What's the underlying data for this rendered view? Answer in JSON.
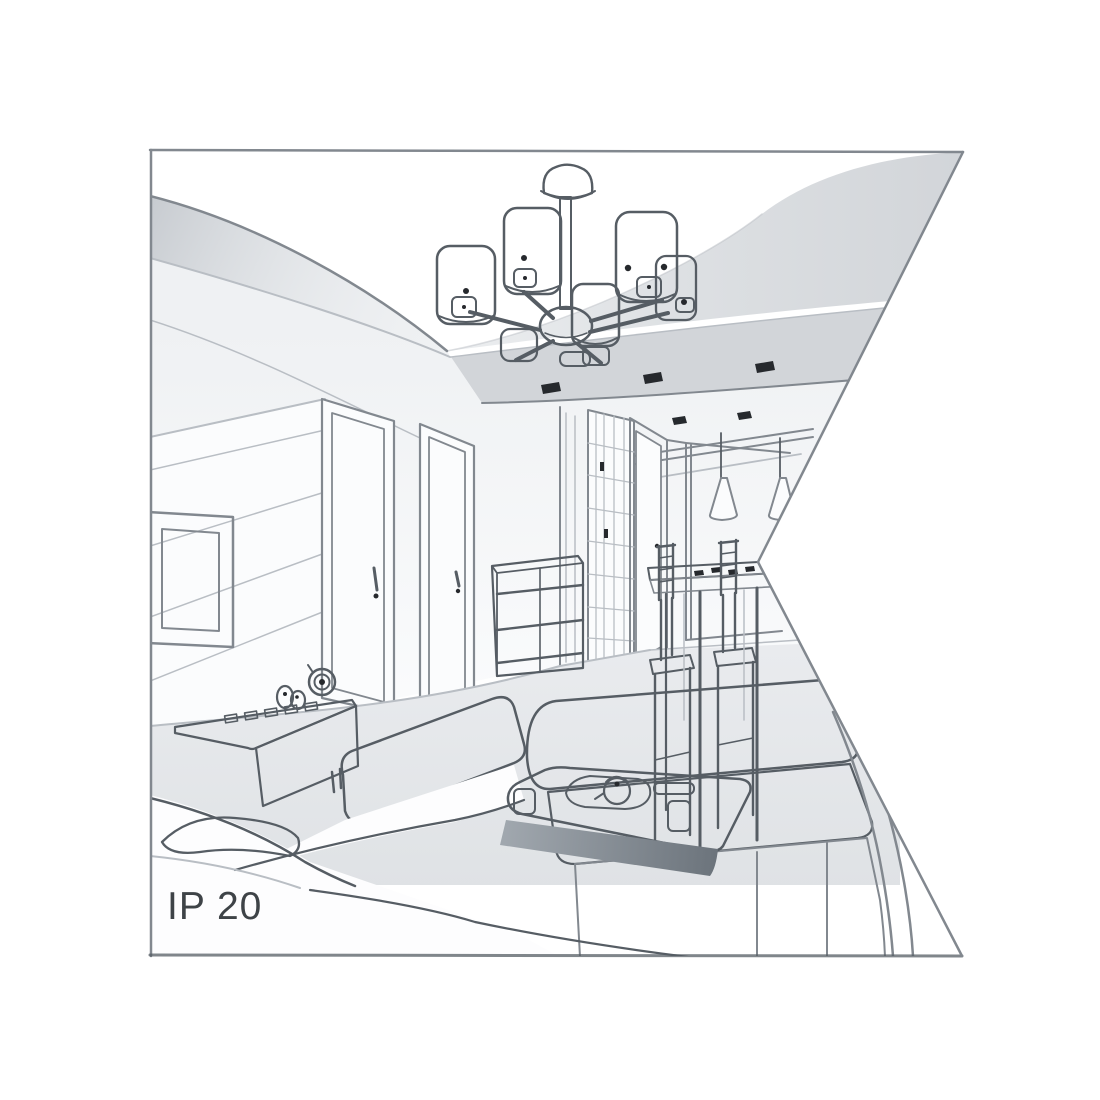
{
  "label": {
    "text": "IP 20"
  },
  "scene": {
    "type": "interior-line-drawing",
    "elements": [
      "chandelier",
      "ceiling-cove",
      "recessed-spotlights",
      "tv-wall-panel",
      "tv-frame",
      "interior-door-1",
      "interior-door-2",
      "wardrobe",
      "chest-of-drawers",
      "hallway-door",
      "pendant-lights",
      "dining-table",
      "dining-chairs",
      "media-sideboard",
      "table-clock",
      "decor-figurines",
      "sofa-left",
      "sofa-right",
      "coffee-table",
      "tea-set",
      "floor"
    ]
  },
  "colors": {
    "background": "#ffffff",
    "line": "#82888f",
    "line_dark": "#565d64",
    "line_light": "#b9bec4",
    "ceiling_gray": "#d6d9dc",
    "soffit_gray": "#d2d5d9",
    "floor_gray": "#e7e9ec",
    "wall_white": "#fbfcfd",
    "accent_dark": "#26292d",
    "shadow": "#9aa1a8",
    "text": "#3e4347"
  }
}
